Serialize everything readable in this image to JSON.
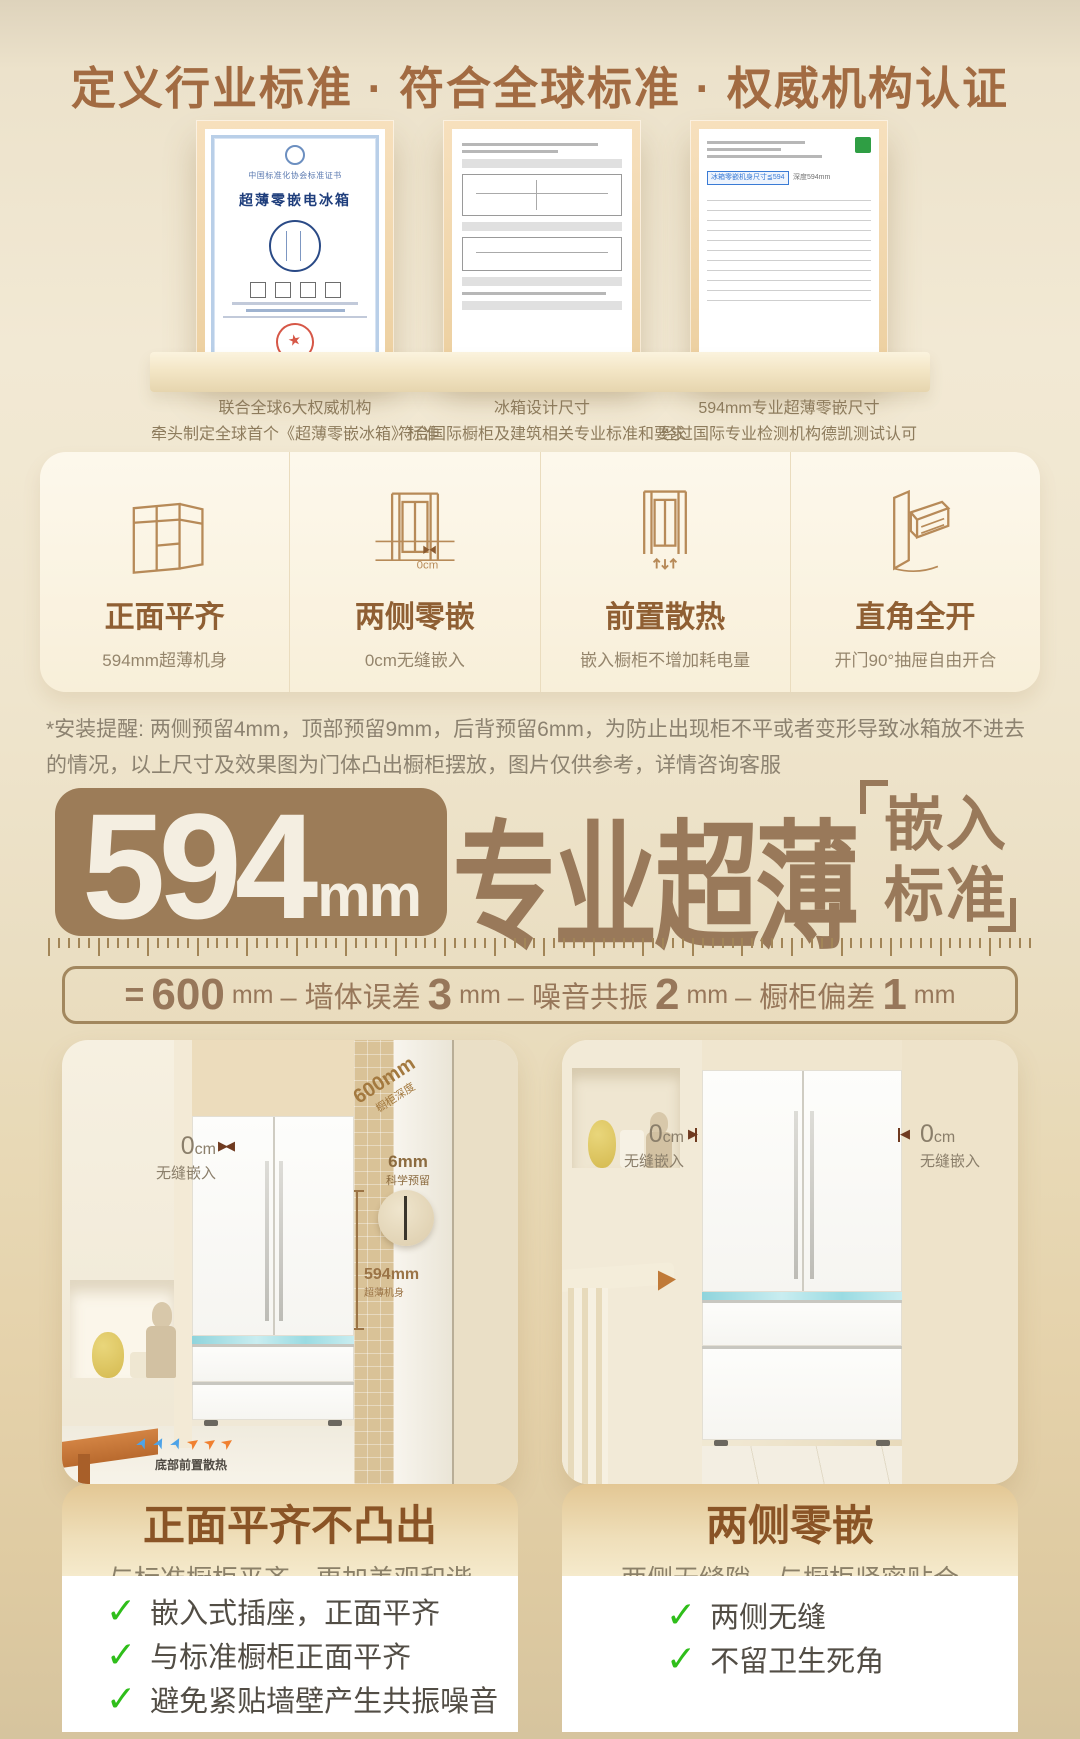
{
  "header": {
    "title": "定义行业标准 · 符合全球标准 · 权威机构认证"
  },
  "certificates": {
    "items": [
      {
        "org": "中国标准化协会标准证书",
        "title": "超薄零嵌电冰箱",
        "caption1": "联合全球6大权威机构",
        "caption2": "牵头制定全球首个《超薄零嵌冰箱》标准"
      },
      {
        "caption1": "冰箱设计尺寸",
        "caption2": "符合国际橱柜及建筑相关专业标准和要求"
      },
      {
        "highlight_callout": "冰箱零嵌机身尺寸≦594",
        "highlight_side": "深度594mm",
        "caption1": "594mm专业超薄零嵌尺寸",
        "caption2": "经过国际专业检测机构德凯测试认可"
      }
    ]
  },
  "features": {
    "items": [
      {
        "title": "正面平齐",
        "subtitle": "594mm超薄机身"
      },
      {
        "title": "两侧零嵌",
        "subtitle": "0cm无缝嵌入",
        "icon_label": "0cm"
      },
      {
        "title": "前置散热",
        "subtitle": "嵌入橱柜不增加耗电量"
      },
      {
        "title": "直角全开",
        "subtitle": "开门90°抽屉自由开合"
      }
    ]
  },
  "install_note": {
    "text": "*安装提醒: 两侧预留4mm，顶部预留9mm，后背预留6mm，为防止出现柜不平或者变形导致冰箱放不进去的情况，以上尺寸及效果图为门体凸出橱柜摆放，图片仅供参考，详情咨询客服"
  },
  "headline": {
    "number": "594",
    "unit": "mm",
    "title": "专业超薄",
    "bracket_top": "嵌入",
    "bracket_bottom": "标准"
  },
  "formula": {
    "eq": "=",
    "n600": "600",
    "u1": "mm",
    "t1": "– 墙体误差",
    "n3": "3",
    "u2": "mm",
    "t2": "– 噪音共振",
    "n2": "2",
    "u3": "mm",
    "t3": "– 橱柜偏差",
    "n1": "1",
    "u4": "mm"
  },
  "photo_left": {
    "zero_num": "0",
    "zero_unit": "cm",
    "zero_label": "无缝嵌入",
    "depth_num": "600mm",
    "depth_label": "橱柜深度",
    "gap_num": "6mm",
    "gap_label": "科学预留",
    "body_num": "594mm",
    "body_label": "超薄机身",
    "vent_label": "底部前置散热"
  },
  "photo_right": {
    "left_zero_num": "0",
    "left_zero_unit": "cm",
    "left_zero_label": "无缝嵌入",
    "right_zero_num": "0",
    "right_zero_unit": "cm",
    "right_zero_label": "无缝嵌入"
  },
  "cards": {
    "left": {
      "title": "正面平齐不凸出",
      "subtitle": "与标准橱柜平齐，更加美观和谐",
      "checks": [
        "嵌入式插座，正面平齐",
        "与标准橱柜正面平齐",
        "避免紧贴墙壁产生共振噪音"
      ]
    },
    "right": {
      "title": "两侧零嵌",
      "subtitle": "两侧无缝隙，与橱柜紧密贴合",
      "checks": [
        "两侧无缝",
        "不留卫生死角"
      ]
    }
  },
  "icons": {
    "check": "✓",
    "arrow_right": "▶",
    "arrow_left": "◀"
  },
  "colors": {
    "accent_brown": "#9c7c58",
    "header_brown": "#a26b42",
    "deep_brown": "#8a5426",
    "check_green": "#2fbe1a",
    "teal_accent": "#9fdbe2",
    "gold_band": "#e3c794"
  }
}
